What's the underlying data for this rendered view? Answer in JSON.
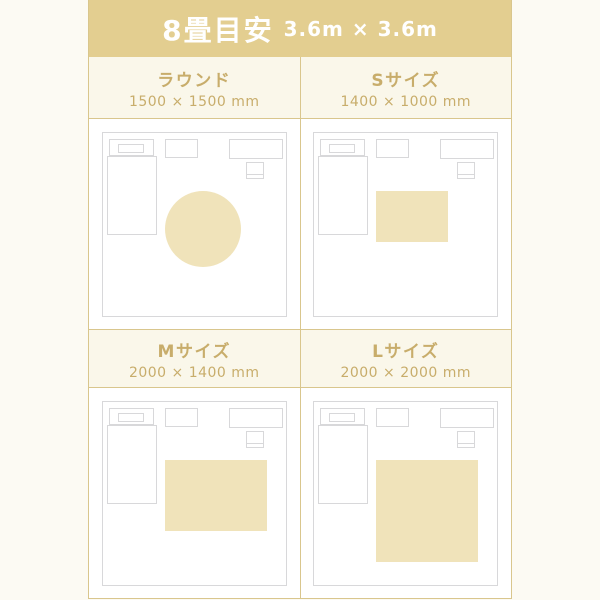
{
  "header": {
    "title": "8畳目安",
    "room_dimensions": "3.6m × 3.6m"
  },
  "room": {
    "width_mm": 3600,
    "depth_mm": 3600,
    "furniture": [
      "bed",
      "pillow",
      "headboard",
      "cabinet",
      "desk",
      "chair"
    ]
  },
  "diagram": {
    "scale_px_per_mm": 0.051,
    "rug_offset_left_px": 62,
    "rug_offset_top_px": 58
  },
  "variants": [
    {
      "name": "ラウンド",
      "size_label": "1500 × 1500 mm",
      "rug": {
        "shape": "round",
        "width_mm": 1500,
        "height_mm": 1500
      }
    },
    {
      "name": "Sサイズ",
      "size_label": "1400 × 1000 mm",
      "rug": {
        "shape": "rect",
        "width_mm": 1400,
        "height_mm": 1000
      }
    },
    {
      "name": "Mサイズ",
      "size_label": "2000 × 1400 mm",
      "rug": {
        "shape": "rect",
        "width_mm": 2000,
        "height_mm": 1400
      }
    },
    {
      "name": "Lサイズ",
      "size_label": "2000 × 2000 mm",
      "rug": {
        "shape": "rect",
        "width_mm": 2000,
        "height_mm": 2000
      }
    }
  ],
  "colors": {
    "page_bg": "#fcfaf3",
    "header_bg": "#e3ce90",
    "header_text": "#ffffff",
    "title_bg": "#faf7ea",
    "title_text": "#c8ad6b",
    "divider": "#d9c68d",
    "diagram_bg": "#ffffff",
    "furniture_border": "#d8d8da",
    "rug_fill": "#f0e3ba"
  }
}
